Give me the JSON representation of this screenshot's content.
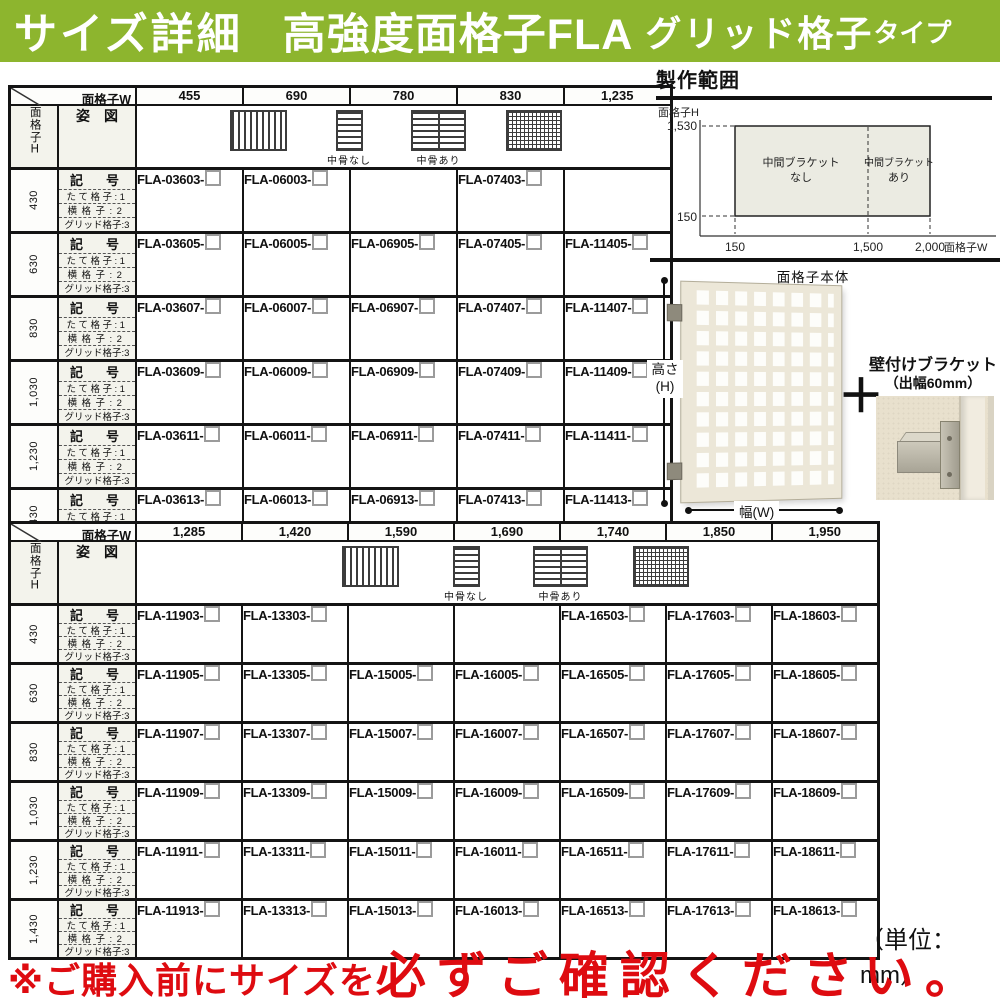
{
  "colors": {
    "header_green": "#8db52e",
    "warning_red": "#de0b10",
    "zone_fill": "#ebebe2",
    "label_bg": "#f3f3ec"
  },
  "header": {
    "title_1": "サイズ詳細",
    "title_2": "高強度面格子FLA",
    "title_3": "グリッド格子",
    "title_4": "タイプ"
  },
  "labels": {
    "w_axis": "面格子W",
    "h_axis": "面格子H",
    "appearance": "姿　図",
    "kigo": "記　号",
    "sub1": "たて格子:1",
    "sub2": "横格子:2",
    "sub3": "グリッド格子:3",
    "cap_nashi": "中骨なし",
    "cap_ari": "中骨あり"
  },
  "tables": [
    {
      "widths": [
        "455",
        "690",
        "780",
        "830",
        "1,235"
      ],
      "rows": [
        {
          "height": "430",
          "codes": [
            "FLA-03603-",
            "FLA-06003-",
            "",
            "FLA-07403-",
            ""
          ]
        },
        {
          "height": "630",
          "codes": [
            "FLA-03605-",
            "FLA-06005-",
            "FLA-06905-",
            "FLA-07405-",
            "FLA-11405-"
          ]
        },
        {
          "height": "830",
          "codes": [
            "FLA-03607-",
            "FLA-06007-",
            "FLA-06907-",
            "FLA-07407-",
            "FLA-11407-"
          ]
        },
        {
          "height": "1,030",
          "codes": [
            "FLA-03609-",
            "FLA-06009-",
            "FLA-06909-",
            "FLA-07409-",
            "FLA-11409-"
          ]
        },
        {
          "height": "1,230",
          "codes": [
            "FLA-03611-",
            "FLA-06011-",
            "FLA-06911-",
            "FLA-07411-",
            "FLA-11411-"
          ]
        },
        {
          "height": "1,430",
          "codes": [
            "FLA-03613-",
            "FLA-06013-",
            "FLA-06913-",
            "FLA-07413-",
            "FLA-11413-"
          ]
        }
      ]
    },
    {
      "widths": [
        "1,285",
        "1,420",
        "1,590",
        "1,690",
        "1,740",
        "1,850",
        "1,950"
      ],
      "rows": [
        {
          "height": "430",
          "codes": [
            "FLA-11903-",
            "FLA-13303-",
            "",
            "",
            "FLA-16503-",
            "FLA-17603-",
            "FLA-18603-"
          ]
        },
        {
          "height": "630",
          "codes": [
            "FLA-11905-",
            "FLA-13305-",
            "FLA-15005-",
            "FLA-16005-",
            "FLA-16505-",
            "FLA-17605-",
            "FLA-18605-"
          ]
        },
        {
          "height": "830",
          "codes": [
            "FLA-11907-",
            "FLA-13307-",
            "FLA-15007-",
            "FLA-16007-",
            "FLA-16507-",
            "FLA-17607-",
            "FLA-18607-"
          ]
        },
        {
          "height": "1,030",
          "codes": [
            "FLA-11909-",
            "FLA-13309-",
            "FLA-15009-",
            "FLA-16009-",
            "FLA-16509-",
            "FLA-17609-",
            "FLA-18609-"
          ]
        },
        {
          "height": "1,230",
          "codes": [
            "FLA-11911-",
            "FLA-13311-",
            "FLA-15011-",
            "FLA-16011-",
            "FLA-16511-",
            "FLA-17611-",
            "FLA-18611-"
          ]
        },
        {
          "height": "1,430",
          "codes": [
            "FLA-11913-",
            "FLA-13313-",
            "FLA-15013-",
            "FLA-16013-",
            "FLA-16513-",
            "FLA-17613-",
            "FLA-18613-"
          ]
        }
      ]
    }
  ],
  "production_range": {
    "title": "製作範囲",
    "y_axis_label": "面格子H",
    "x_axis_label": "面格子W",
    "y_max": "1,530",
    "y_min": "150",
    "x_min": "150",
    "x_mid": "1,500",
    "x_max": "2,000",
    "zone_left_1": "中間ブラケット",
    "zone_left_2": "なし",
    "zone_right_1": "中間ブラケット",
    "zone_right_2": "あり"
  },
  "product": {
    "body_label": "面格子本体",
    "height_label": "高さ",
    "height_unit": "(H)",
    "width_label": "幅(W)",
    "plus": "＋",
    "bracket_label_1": "壁付けブラケット",
    "bracket_label_2": "（出幅60mm）"
  },
  "footer": {
    "unit_note": "（単位：mm）",
    "warning_prefix": "※ご購入前にサイズを",
    "warning_emphasis": "必ずご確認ください。"
  }
}
